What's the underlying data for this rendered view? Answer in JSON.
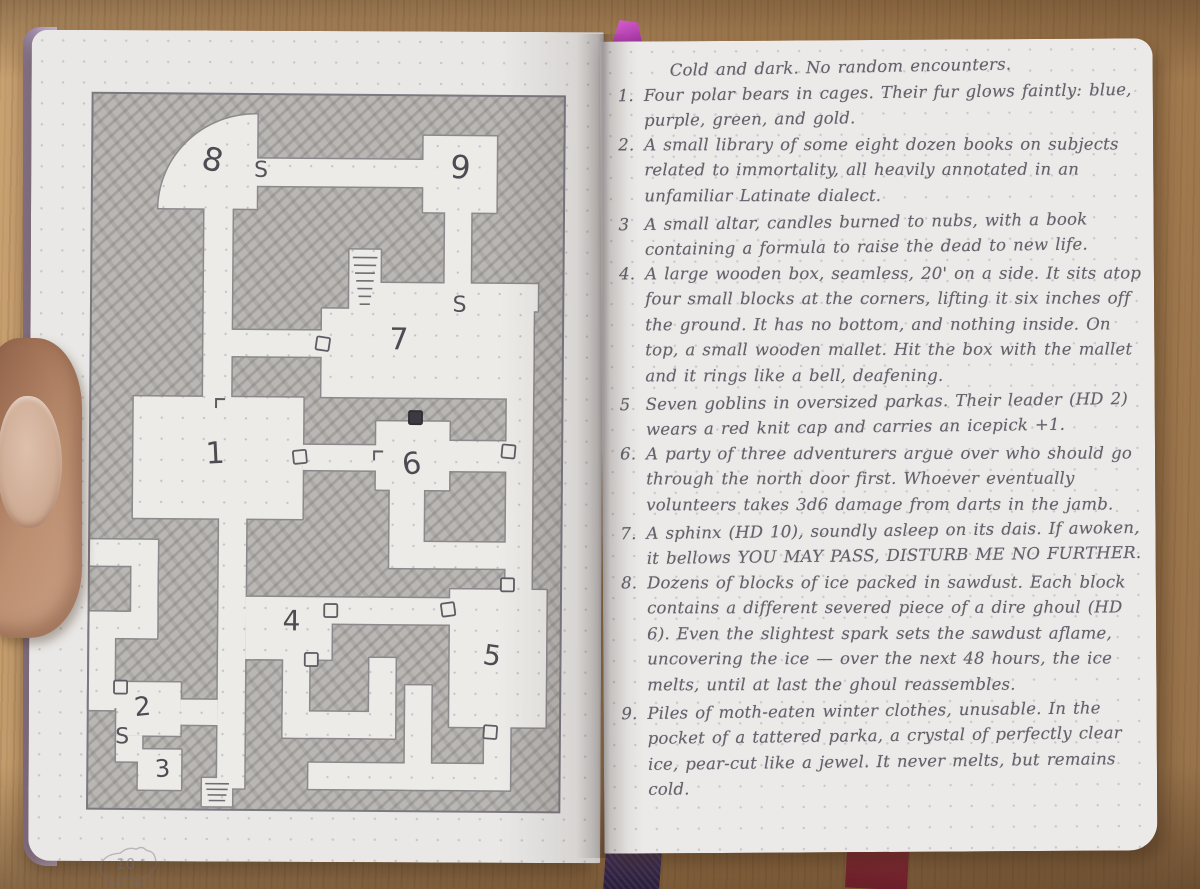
{
  "colors": {
    "graphite_text": "#63626b",
    "pencil_line": "#87858a",
    "map_shading": "#b9b6b3",
    "room_floor": "#edebe8",
    "page": "#eceae8",
    "wood_light": "#c9a272",
    "wood_dark": "#96714a",
    "cover_edge": "#b7a3c3",
    "ribbon_top": "#b13fae",
    "ribbon_purple": "#332546",
    "ribbon_maroon": "#7c2530"
  },
  "left_page": {
    "page_number": "10",
    "map": {
      "floor_shapes": [
        {
          "type": "path",
          "d": "M166,22 A97,95 0 0 0 68,116 L166,116 Z"
        },
        {
          "type": "rect",
          "x": 114,
          "y": 112,
          "w": 28,
          "h": 196
        },
        {
          "type": "rect",
          "x": 163,
          "y": 66,
          "w": 170,
          "h": 27
        },
        {
          "type": "rect",
          "x": 332,
          "y": 42,
          "w": 73,
          "h": 76
        },
        {
          "type": "rect",
          "x": 354,
          "y": 117,
          "w": 26,
          "h": 76
        },
        {
          "type": "rect",
          "x": 287,
          "y": 189,
          "w": 160,
          "h": 27
        },
        {
          "type": "rect",
          "x": 417,
          "y": 214,
          "w": 26,
          "h": 284
        },
        {
          "type": "rect",
          "x": 259,
          "y": 156,
          "w": 31,
          "h": 62
        },
        {
          "type": "rect",
          "x": 232,
          "y": 215,
          "w": 211,
          "h": 88
        },
        {
          "type": "rect",
          "x": 114,
          "y": 237,
          "w": 120,
          "h": 26
        },
        {
          "type": "rect",
          "x": 45,
          "y": 304,
          "w": 169,
          "h": 121
        },
        {
          "type": "rect",
          "x": 214,
          "y": 351,
          "w": 74,
          "h": 25
        },
        {
          "type": "rect",
          "x": 287,
          "y": 327,
          "w": 73,
          "h": 68
        },
        {
          "type": "rect",
          "x": 359,
          "y": 346,
          "w": 60,
          "h": 30
        },
        {
          "type": "rect",
          "x": 301,
          "y": 394,
          "w": 34,
          "h": 56
        },
        {
          "type": "rect",
          "x": 301,
          "y": 447,
          "w": 117,
          "h": 26
        },
        {
          "type": "rect",
          "x": 362,
          "y": 494,
          "w": 96,
          "h": 137
        },
        {
          "type": "rect",
          "x": 158,
          "y": 503,
          "w": 86,
          "h": 62
        },
        {
          "type": "rect",
          "x": 242,
          "y": 503,
          "w": 121,
          "h": 26
        },
        {
          "type": "rect",
          "x": 131,
          "y": 424,
          "w": 27,
          "h": 270
        },
        {
          "type": "rect",
          "x": 2,
          "y": 447,
          "w": 68,
          "h": 26
        },
        {
          "type": "rect",
          "x": 44,
          "y": 447,
          "w": 26,
          "h": 98
        },
        {
          "type": "rect",
          "x": 2,
          "y": 519,
          "w": 68,
          "h": 26
        },
        {
          "type": "rect",
          "x": 2,
          "y": 519,
          "w": 26,
          "h": 98
        },
        {
          "type": "rect",
          "x": 2,
          "y": 591,
          "w": 40,
          "h": 24
        },
        {
          "type": "rect",
          "x": 30,
          "y": 589,
          "w": 64,
          "h": 53
        },
        {
          "type": "rect",
          "x": 30,
          "y": 642,
          "w": 26,
          "h": 26
        },
        {
          "type": "rect",
          "x": 52,
          "y": 656,
          "w": 43,
          "h": 40
        },
        {
          "type": "rect",
          "x": 94,
          "y": 606,
          "w": 37,
          "h": 25
        },
        {
          "type": "rect",
          "x": 196,
          "y": 563,
          "w": 26,
          "h": 80
        },
        {
          "type": "rect",
          "x": 196,
          "y": 617,
          "w": 112,
          "h": 26
        },
        {
          "type": "rect",
          "x": 282,
          "y": 563,
          "w": 26,
          "h": 80
        },
        {
          "type": "rect",
          "x": 222,
          "y": 668,
          "w": 201,
          "h": 26
        },
        {
          "type": "rect",
          "x": 318,
          "y": 590,
          "w": 26,
          "h": 104
        },
        {
          "type": "rect",
          "x": 116,
          "y": 684,
          "w": 30,
          "h": 28
        },
        {
          "type": "rect",
          "x": 397,
          "y": 628,
          "w": 26,
          "h": 44
        }
      ],
      "room_labels": [
        {
          "label": "8",
          "x": 119,
          "y": 78,
          "rot": 14,
          "size": 32
        },
        {
          "label": "9",
          "x": 368,
          "y": 84,
          "rot": 4,
          "size": 32
        },
        {
          "label": "7",
          "x": 309,
          "y": 255,
          "rot": 0,
          "size": 30
        },
        {
          "label": "1",
          "x": 127,
          "y": 370,
          "rot": -3,
          "size": 30
        },
        {
          "label": "6",
          "x": 324,
          "y": 379,
          "rot": -8,
          "size": 30
        },
        {
          "label": "4",
          "x": 204,
          "y": 536,
          "rot": 0,
          "size": 28
        },
        {
          "label": "5",
          "x": 403,
          "y": 569,
          "rot": 8,
          "size": 28
        },
        {
          "label": "2",
          "x": 57,
          "y": 622,
          "rot": -6,
          "size": 26
        },
        {
          "label": "3",
          "x": 77,
          "y": 683,
          "rot": -4,
          "size": 24
        }
      ],
      "secret_door_marks": [
        {
          "label": "S",
          "x": 170,
          "y": 84
        },
        {
          "label": "S",
          "x": 369,
          "y": 217
        },
        {
          "label": "S",
          "x": 36,
          "y": 650
        }
      ],
      "doors": [
        {
          "x": 233,
          "y": 250,
          "style": "outline",
          "rot": 8
        },
        {
          "x": 326,
          "y": 323,
          "style": "filled",
          "rot": 0
        },
        {
          "x": 211,
          "y": 363,
          "style": "outline",
          "rot": -6
        },
        {
          "x": 419,
          "y": 356,
          "style": "outline",
          "rot": 5
        },
        {
          "x": 419,
          "y": 489,
          "style": "outline",
          "rot": 0
        },
        {
          "x": 403,
          "y": 636,
          "style": "outline",
          "rot": 4
        },
        {
          "x": 243,
          "y": 516,
          "style": "outline",
          "rot": 0
        },
        {
          "x": 360,
          "y": 514,
          "style": "outline",
          "rot": -8
        },
        {
          "x": 224,
          "y": 565,
          "style": "outline",
          "rot": 0
        },
        {
          "x": 34,
          "y": 594,
          "style": "outline",
          "rot": 0
        }
      ],
      "stairs": [
        {
          "x": 259,
          "y": 156,
          "w": 31,
          "h": 62,
          "steps": 7
        },
        {
          "x": 116,
          "y": 684,
          "w": 30,
          "h": 28,
          "steps": 4
        }
      ],
      "tick_marks": [
        {
          "x": 127,
          "y": 306
        },
        {
          "x": 285,
          "y": 357
        }
      ]
    }
  },
  "right_page": {
    "page_number": "11",
    "intro": "Cold and dark. No random encounters.",
    "entries": [
      {
        "num": "1.",
        "text": "Four polar bears in cages. Their fur glows faintly: blue, purple, green, and gold."
      },
      {
        "num": "2.",
        "text": "A small library of some eight dozen books on subjects related to immortality, all heavily annotated in an unfamiliar Latinate dialect."
      },
      {
        "num": "3",
        "text": "A small altar, candles burned to nubs, with a book containing a formula to raise the dead to new life."
      },
      {
        "num": "4.",
        "text": "A large wooden box, seamless, 20' on a side. It sits atop four small blocks at the corners, lifting it six inches off the ground. It has no bottom, and nothing inside. On top, a small wooden mallet. Hit the box with the mallet and it rings like a bell, deafening."
      },
      {
        "num": "5",
        "text": "Seven goblins in oversized parkas. Their leader (HD 2) wears a red knit cap and carries an icepick +1."
      },
      {
        "num": "6.",
        "text": "A party of three adventurers argue over who should go through the north door first. Whoever eventually volunteers takes 3d6 damage from darts in the jamb."
      },
      {
        "num": "7.",
        "text": "A sphinx (HD 10), soundly asleep on its dais. If awoken, it bellows YOU MAY PASS, DISTURB ME NO FURTHER."
      },
      {
        "num": "8.",
        "text": "Dozens of blocks of ice packed in sawdust. Each block contains a different severed piece of a dire ghoul (HD 6). Even the slightest spark sets the sawdust aflame, uncovering the ice — over the next 48 hours, the ice melts, until at last the ghoul reassembles."
      },
      {
        "num": "9.",
        "text": "Piles of moth-eaten winter clothes, unusable. In the pocket of a tattered parka, a crystal of perfectly clear ice, pear-cut like a jewel. It never melts, but remains cold."
      }
    ]
  }
}
